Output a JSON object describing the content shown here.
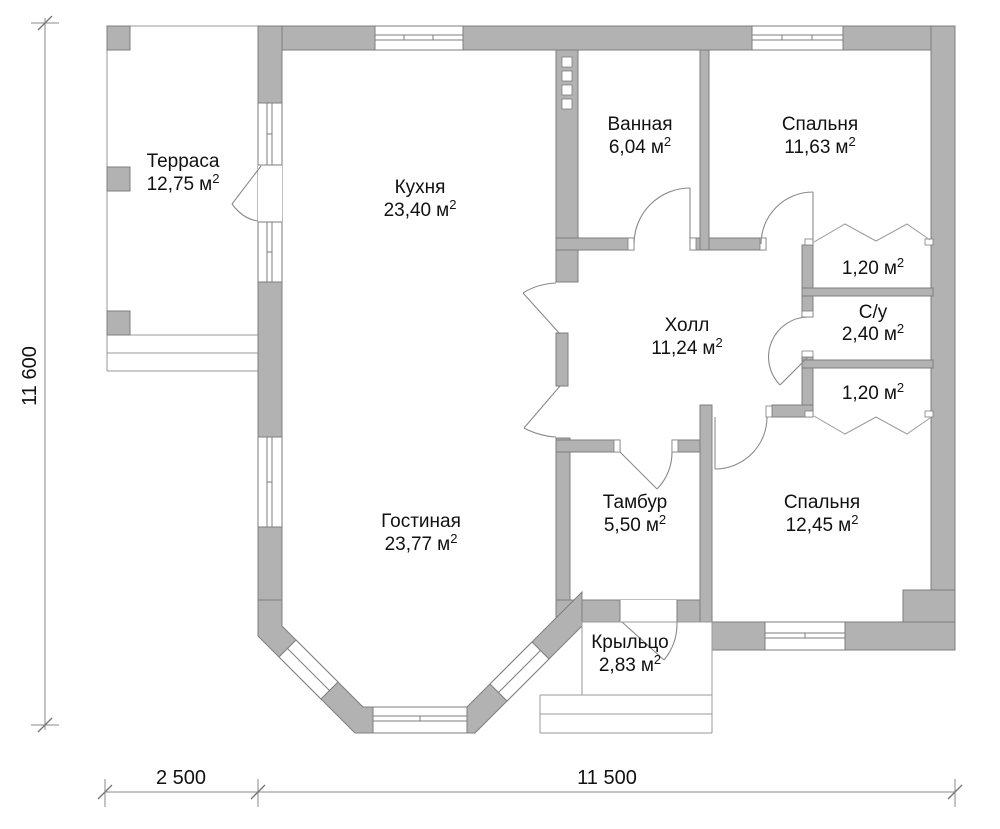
{
  "plan": {
    "rooms": {
      "terrace": {
        "name": "Терраса",
        "area": "12,75"
      },
      "kitchen": {
        "name": "Кухня",
        "area": "23,40"
      },
      "bathroom": {
        "name": "Ванная",
        "area": "6,04"
      },
      "bedroom1": {
        "name": "Спальня",
        "area": "11,63"
      },
      "closet1": {
        "area": "1,20"
      },
      "wc": {
        "name": "С/у",
        "area": "2,40"
      },
      "closet2": {
        "area": "1,20"
      },
      "hall": {
        "name": "Холл",
        "area": "11,24"
      },
      "living": {
        "name": "Гостиная",
        "area": "23,77"
      },
      "tambour": {
        "name": "Тамбур",
        "area": "5,50"
      },
      "bedroom2": {
        "name": "Спальня",
        "area": "12,45"
      },
      "porch": {
        "name": "Крыльцо",
        "area": "2,83"
      }
    },
    "unit": "м",
    "unit_sup": "2",
    "dimensions": {
      "height": "11 600",
      "terrace_width": "2 500",
      "house_width": "11 500"
    },
    "colors": {
      "wall_fill": "#b2b2b2",
      "wall_stroke": "#7e7e7e",
      "thin_line": "#9a9a9a",
      "door_line": "#8a8a8a",
      "text": "#111111"
    }
  }
}
